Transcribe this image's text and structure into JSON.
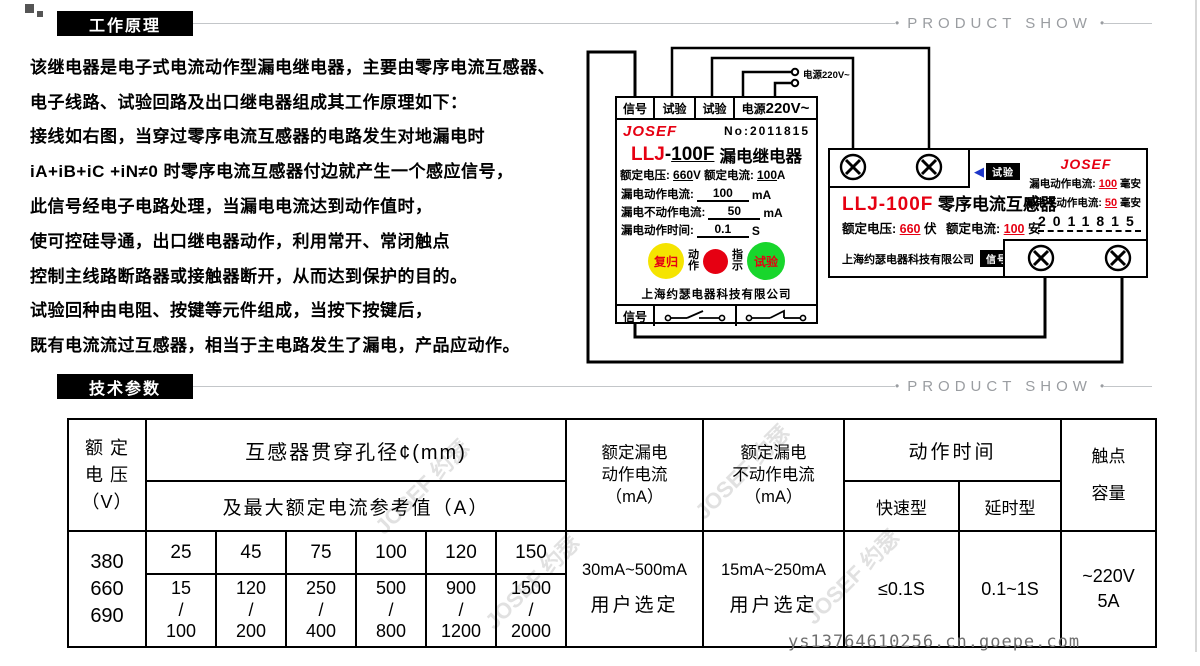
{
  "page": {
    "section1": "工作原理",
    "section2": "技术参数",
    "product_show": "PRODUCT SHOW",
    "bullet": "•",
    "watermark_url": "ys13764610256.cn.goepe.com",
    "watermark_brand": "JOSEF 约瑟"
  },
  "principle": {
    "lines": [
      "该继电器是电子式电流动作型漏电继电器，主要由零序电流互感器、",
      "电子线路、试验回路及出口继电器组成其工作原理如下：",
      "接线如右图，当穿过零序电流互感器的电路发生对地漏电时",
      "iA+iB+iC +iN≠0 时零序电流互感器付边就产生一个感应信号，",
      "此信号经电子电路处理，当漏电电流达到动作值时，",
      "使可控硅导通，出口继电器动作，利用常开、常闭触点",
      "控制主线路断路器或接触器断开，从而达到保护的目的。",
      "试验回种由电阻、按键等元件组成，当按下按键后，",
      "既有电流流过互感器，相当于主电路发生了漏电，产品应动作。"
    ]
  },
  "power_label": "电源220V~",
  "relay": {
    "terminal1": "信号",
    "terminal2": "试验",
    "terminal3": "试验",
    "terminal_power_label": "电源",
    "terminal_power_value": "220V~",
    "brand": "JOSEF",
    "serial": "No:2011815",
    "model_prefix": "LLJ",
    "model_dash": "-",
    "model_suffix": "100F",
    "title": "漏电继电器",
    "rating_v_label": "额定电压:",
    "rating_v": "660",
    "rating_v_unit": "V",
    "rating_a_label": "额定电流:",
    "rating_a": "100",
    "rating_a_unit": "A",
    "spec_rows": [
      {
        "label": "漏电动作电流:",
        "value": "100",
        "unit": "mA"
      },
      {
        "label": "漏电不动作电流:",
        "value": "50",
        "unit": "mA"
      },
      {
        "label": "漏电动作时间:",
        "value": "0.1",
        "unit": "S"
      }
    ],
    "btn_reset": "复归",
    "lbl_action": "动\n作",
    "lbl_indicate": "指\n示",
    "btn_test": "试验",
    "company": "上海约瑟电器科技有限公司",
    "bottom_terminal": "信号",
    "btn_reset_color": "#f5e400",
    "lamp_color": "#e60012",
    "btn_test_color": "#18d62c"
  },
  "transformer": {
    "brand": "JOSEF",
    "spec1_label": "漏电动作电流:",
    "spec1_value": "100",
    "spec1_unit": "毫安",
    "spec2_label": "漏电不动作电流:",
    "spec2_value": "50",
    "spec2_unit": "毫安",
    "serial": "2011815",
    "model": "LLJ-100F",
    "title": "零序电流互感器",
    "rating_v_label": "额定电压:",
    "rating_v": "660",
    "rating_v_unit": "伏",
    "rating_a_label": "额定电流:",
    "rating_a": "100",
    "rating_a_unit": "安",
    "company": "上海约瑟电器科技有限公司",
    "tag_test": "试验",
    "tag_signal": "信号"
  },
  "table": {
    "h_voltage": "额 定\n电 压\n（V）",
    "h_diameter": "互感器贯穿孔径¢(mm)",
    "h_current_ref": "及最大额定电流参考值（A）",
    "h_action": "额定漏电\n动作电流\n（mA）",
    "h_noaction": "额定漏电\n不动作电流\n（mA）",
    "h_time": "动作时间",
    "h_fast": "快速型",
    "h_delay": "延时型",
    "h_contact": "触点\n容量",
    "voltages": "380\n660\n690",
    "diameters": [
      "25",
      "45",
      "75",
      "100",
      "120",
      "150"
    ],
    "currents": [
      "15\n/\n100",
      "120\n/\n200",
      "250\n/\n400",
      "500\n/\n800",
      "900\n/\n1200",
      "1500\n/\n2000"
    ],
    "action_range": "30mA~500mA",
    "action_note": "用户选定",
    "noaction_range": "15mA~250mA",
    "noaction_note": "用户选定",
    "fast_value": "≤0.1S",
    "delay_value": "0.1~1S",
    "contact_value": "~220V\n5A"
  }
}
